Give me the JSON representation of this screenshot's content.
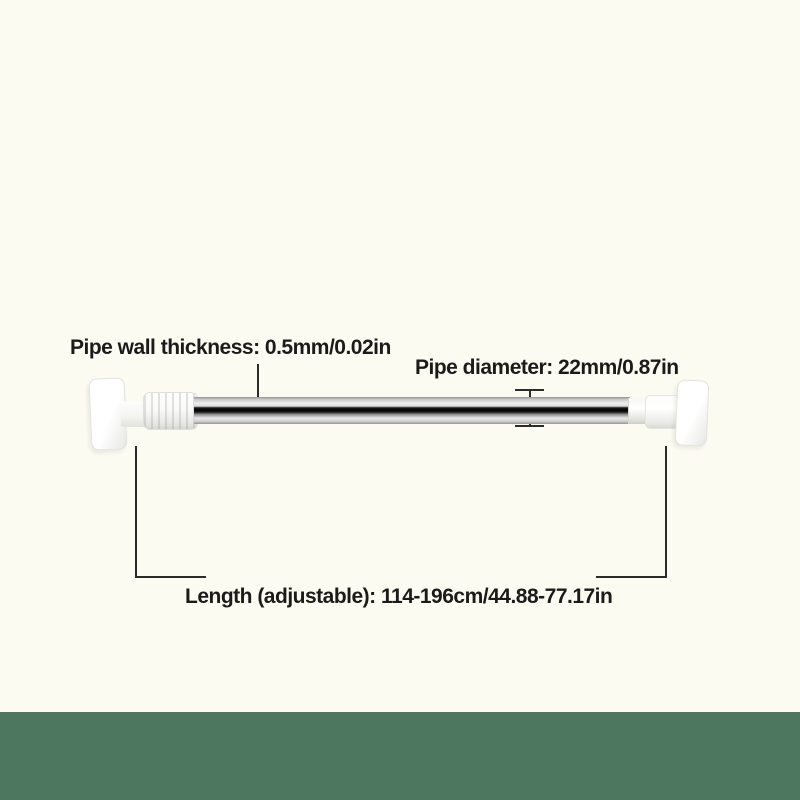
{
  "colors": {
    "background": "#fcfbf2",
    "footer_bar": "#4d775e",
    "annotation_line": "#2b2b2b"
  },
  "labels": {
    "pipe_wall_thickness": "Pipe wall thickness: 0.5mm/0.02in",
    "pipe_diameter": "Pipe diameter: 22mm/0.87in",
    "length_adjustable": "Length (adjustable): 114-196cm/44.88-77.17in"
  }
}
